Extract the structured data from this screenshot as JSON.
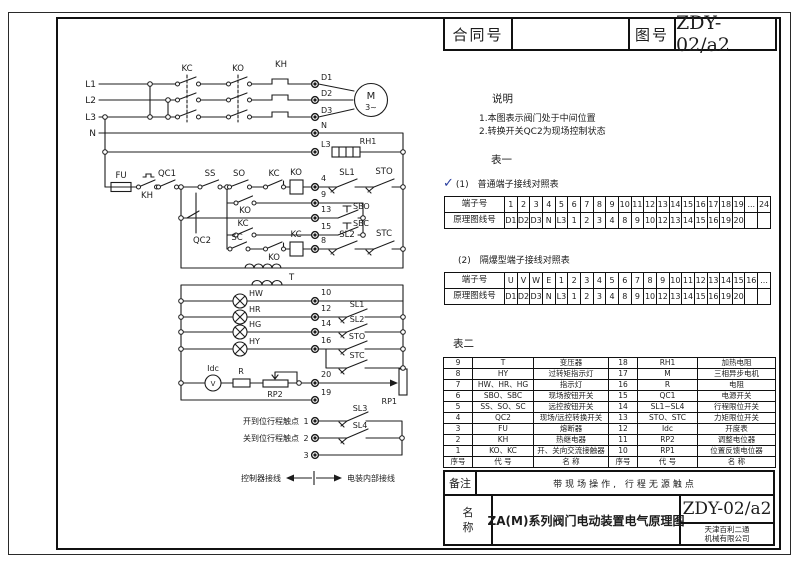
{
  "colors": {
    "ink": "#1c1c1c",
    "check_mark": "#2a3f9f",
    "paper": "#ffffff"
  },
  "header": {
    "contract_label": "合同号",
    "contract_value": "",
    "drawing_label": "图号",
    "drawing_number": "ZDY-02/a2"
  },
  "notes": {
    "title": "说明",
    "items": [
      "1.本图表示阀门处于中间位置",
      "2.转换开关QC2为现场控制状态"
    ]
  },
  "table1": {
    "section": "表一",
    "check": "✓",
    "caption": "(1)　普通端子接线对照表",
    "rows": [
      [
        "端子号",
        "1",
        "2",
        "3",
        "4",
        "5",
        "6",
        "7",
        "8",
        "9",
        "10",
        "11",
        "12",
        "13",
        "14",
        "15",
        "16",
        "17",
        "18",
        "19",
        "...",
        "24"
      ],
      [
        "原理图线号",
        "D1",
        "D2",
        "D3",
        "N",
        "L3",
        "1",
        "2",
        "3",
        "4",
        "8",
        "9",
        "10",
        "12",
        "13",
        "14",
        "15",
        "16",
        "19",
        "20",
        "",
        ""
      ]
    ]
  },
  "table1b": {
    "caption": "(2)　隔爆型端子接线对照表",
    "rows": [
      [
        "端子号",
        "U",
        "V",
        "W",
        "E",
        "1",
        "2",
        "3",
        "4",
        "5",
        "6",
        "7",
        "8",
        "9",
        "10",
        "11",
        "12",
        "13",
        "14",
        "15",
        "16",
        "..."
      ],
      [
        "原理图线号",
        "D1",
        "D2",
        "D3",
        "N",
        "L3",
        "1",
        "2",
        "3",
        "4",
        "8",
        "9",
        "10",
        "12",
        "13",
        "14",
        "15",
        "16",
        "19",
        "20",
        "",
        ""
      ]
    ]
  },
  "table2": {
    "section": "表二",
    "rows": [
      [
        "9",
        "T",
        "变压器",
        "18",
        "RH1",
        "加热电阻"
      ],
      [
        "8",
        "HY",
        "过转矩指示灯",
        "17",
        "M",
        "三相异步电机"
      ],
      [
        "7",
        "HW、HR、HG",
        "指示灯",
        "16",
        "R",
        "电阻"
      ],
      [
        "6",
        "SBO、SBC",
        "现场按钮开关",
        "15",
        "QC1",
        "电源开关"
      ],
      [
        "5",
        "SS、SO、SC",
        "远控按钮开关",
        "14",
        "SL1~SL4",
        "行程限位开关"
      ],
      [
        "4",
        "QC2",
        "现场/远控转换开关",
        "13",
        "STO、STC",
        "力矩限位开关"
      ],
      [
        "3",
        "FU",
        "熔断器",
        "12",
        "Idc",
        "开度表"
      ],
      [
        "2",
        "KH",
        "热继电器",
        "11",
        "RP2",
        "调整电位器"
      ],
      [
        "1",
        "KO、KC",
        "开、关向交流接触器",
        "10",
        "RP1",
        "位置反馈电位器"
      ],
      [
        "序号",
        "代  号",
        "名  称",
        "序号",
        "代  号",
        "名  称"
      ]
    ]
  },
  "remark": {
    "label": "备注",
    "text": "带现场操作, 行程无源触点"
  },
  "titleblock": {
    "label": "名称",
    "title": "ZA(M)系列阀门电动装置电气原理图",
    "drawing_number": "ZDY-02/a2",
    "company_line1": "天津百利二通",
    "company_line2": "机械有限公司"
  },
  "circuit": {
    "phases": {
      "l1": "L1",
      "l2": "L2",
      "l3": "L3",
      "n": "N"
    },
    "power": {
      "kc": "KC",
      "ko": "KO",
      "kh": "KH",
      "d1": "D1",
      "d2": "D2",
      "d3": "D3",
      "n": "N",
      "l3": "L3",
      "rh1": "RH1",
      "motor": "M",
      "motor_sub": "3~"
    },
    "control": {
      "fu": "FU",
      "kh": "KH",
      "qc1": "QC1",
      "qc2": "QC2",
      "ss": "SS",
      "so": "SO",
      "sc": "SC",
      "kc_contact": "KC",
      "ko_coil": "KO",
      "ko_contact": "KO",
      "kc_aux": "KC",
      "ko_nc": "KO",
      "kc_coil": "KC",
      "t4": "4",
      "t9": "9",
      "t13": "13",
      "t15": "15",
      "t8": "8",
      "sbo": "SBO",
      "sbc": "SBC",
      "sl1": "SL1",
      "sto": "STO",
      "sl2": "SL2",
      "stc": "STC",
      "t": "T"
    },
    "lamps": {
      "hw": "HW",
      "hr": "HR",
      "hg": "HG",
      "hy": "HY",
      "t10": "10",
      "t12": "12",
      "t14": "14",
      "t16": "16",
      "sl1": "SL1",
      "sl2": "SL2",
      "sto": "STO",
      "stc": "STC"
    },
    "feedback": {
      "idc": "Idc",
      "meter": "V",
      "r": "R",
      "rp2": "RP2",
      "rp1": "RP1",
      "t20": "20",
      "t19": "19"
    },
    "travel": {
      "open_label": "开到位行程触点",
      "close_label": "关到位行程触点",
      "t1": "1",
      "t2": "2",
      "t3": "3",
      "sl3": "SL3",
      "sl4": "SL4"
    },
    "wiring_note": {
      "left": "控制器接线",
      "right": "电装内部接线"
    }
  }
}
